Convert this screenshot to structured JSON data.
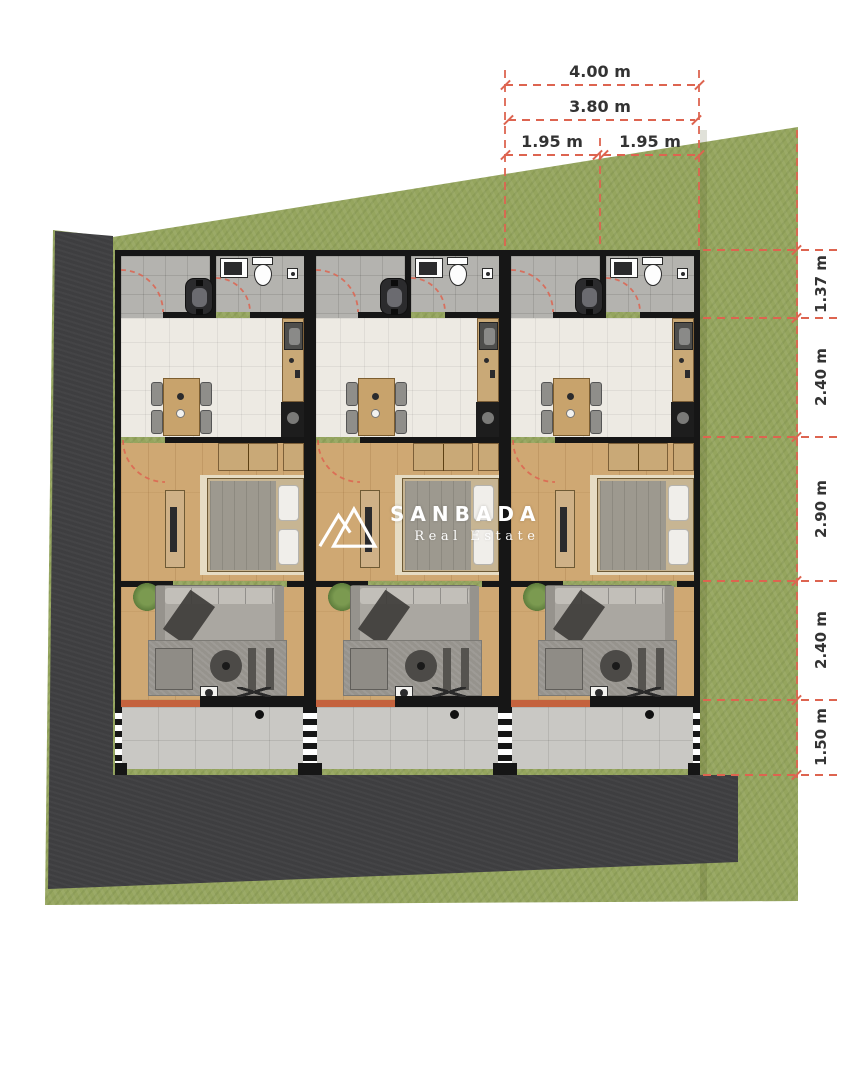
{
  "logo": {
    "brand": "SANBADA",
    "tagline": "Real Estate",
    "icon": "mountain-peaks-icon",
    "color": "#ffffff"
  },
  "dimensions": {
    "top": {
      "overall": "4.00 m",
      "inner": "3.80 m",
      "left_half": "1.95 m",
      "right_half": "1.95 m"
    },
    "right": [
      "1.37 m",
      "2.40 m",
      "2.90 m",
      "2.40 m",
      "1.50 m"
    ]
  },
  "units": [
    {
      "name": "unit-1"
    },
    {
      "name": "unit-2"
    },
    {
      "name": "unit-3"
    }
  ],
  "rooms_per_unit": [
    "entry-carport",
    "bathroom",
    "dining-kitchen",
    "bedroom",
    "living-room",
    "terrace"
  ],
  "colors": {
    "background": "#ffffff",
    "grass": "#95a55e",
    "road": "#3e3e40",
    "wall": "#161616",
    "tile_gray": "#b4b3af",
    "tile_light": "#edeae3",
    "wood": "#cfa873",
    "concrete": "#c9c8c4",
    "terracotta": "#c4623d",
    "accent_dimension": "#dd6450",
    "dimension_text": "#333333",
    "logo_white": "#ffffff"
  }
}
